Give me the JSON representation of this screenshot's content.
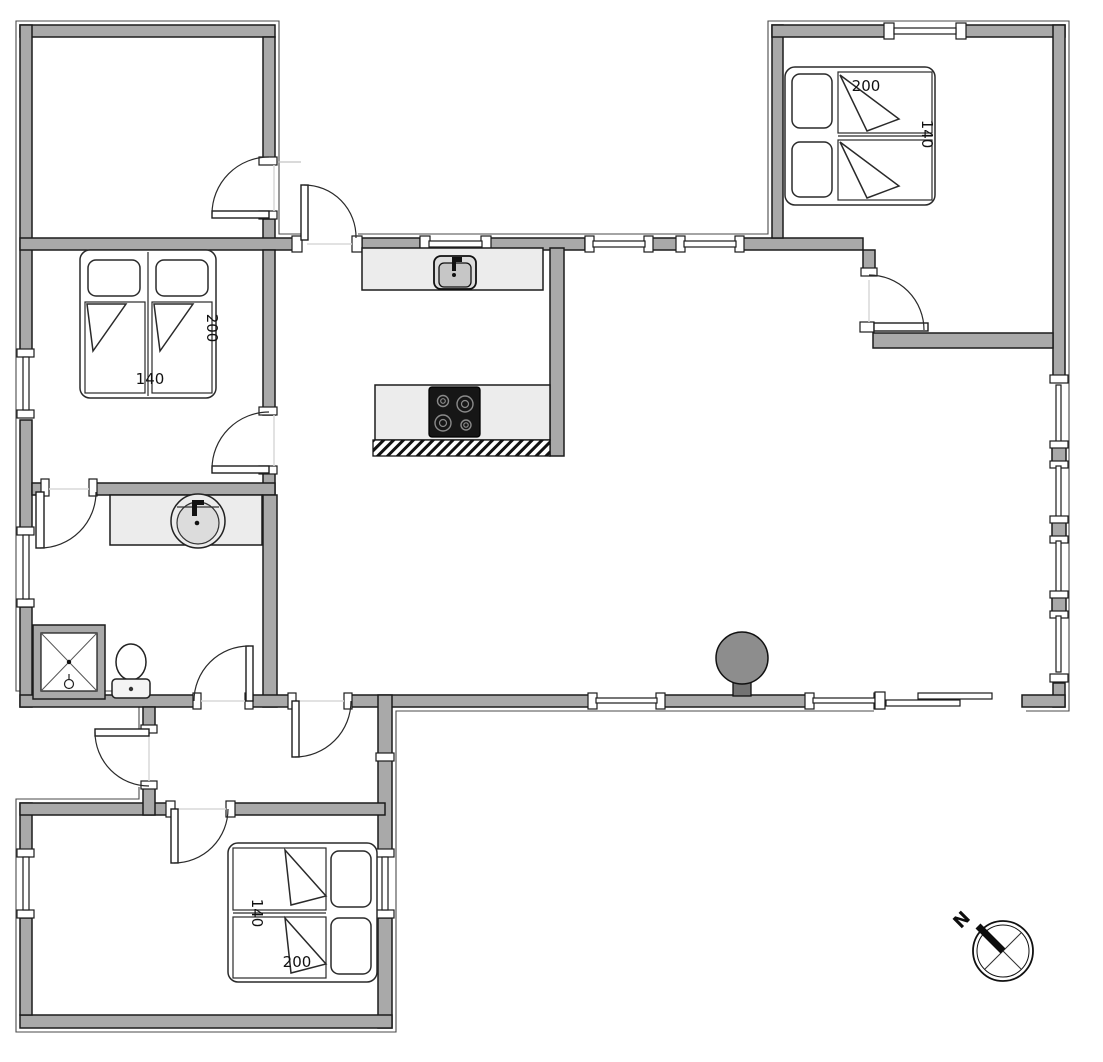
{
  "floor_plan": {
    "bedroom_left": {
      "bed": {
        "length_cm": "200",
        "width_cm": "140"
      }
    },
    "bedroom_top_right": {
      "bed": {
        "length_cm": "200",
        "width_cm": "140"
      }
    },
    "bedroom_bottom": {
      "bed": {
        "length_cm": "200",
        "width_cm": "140"
      }
    },
    "compass": {
      "north": "N"
    },
    "colors": {
      "wall": "#a9a9a9",
      "counter": "#ececec",
      "stove_top": "#161616",
      "fireplace": "#8d8d8d",
      "line": "#1c1c1c",
      "background": "#ffffff"
    }
  }
}
